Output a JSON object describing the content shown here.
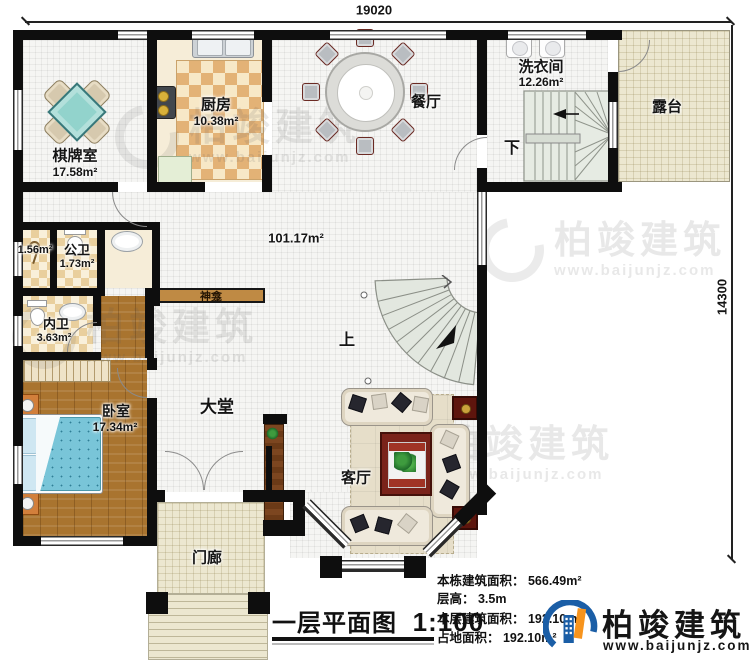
{
  "dimensions": {
    "top": "19020",
    "right": "14300"
  },
  "rooms": {
    "qipaishi": {
      "name": "棋牌室",
      "area": "17.58m²"
    },
    "chufang": {
      "name": "厨房",
      "area": "10.38m²"
    },
    "canting": {
      "name": "餐厅"
    },
    "xiyijian": {
      "name": "洗衣间",
      "area": "12.26m²"
    },
    "lutai": {
      "name": "露台"
    },
    "shower": {
      "area": "1.56m²"
    },
    "gongwei": {
      "name": "公卫",
      "area": "1.73m²"
    },
    "neiwei": {
      "name": "内卫",
      "area": "3.63m²"
    },
    "woshi": {
      "name": "卧室",
      "area": "17.34m²"
    },
    "datang": {
      "name": "大堂",
      "area": "101.17m²"
    },
    "keting": {
      "name": "客厅"
    },
    "menlang": {
      "name": "门廊"
    },
    "shenkan": {
      "name": "神龛"
    }
  },
  "stairs": {
    "up": "上",
    "down": "下"
  },
  "title": {
    "name": "一层平面图",
    "scale": "1:100"
  },
  "stats": [
    "本栋建筑面积： 566.49m²",
    "层高： 3.5m",
    "本层建筑面积： 192.10m²",
    "占地面积： 192.10m²"
  ],
  "brand": {
    "name": "柏竣建筑",
    "site": "www.baijunjz.com"
  },
  "watermark": {
    "name": "柏竣建筑",
    "site": "www.baijunjz.com"
  },
  "colors": {
    "accent_blue": "#1b5ea6",
    "accent_orange": "#f7941d",
    "wall": "#0e0e0e"
  }
}
